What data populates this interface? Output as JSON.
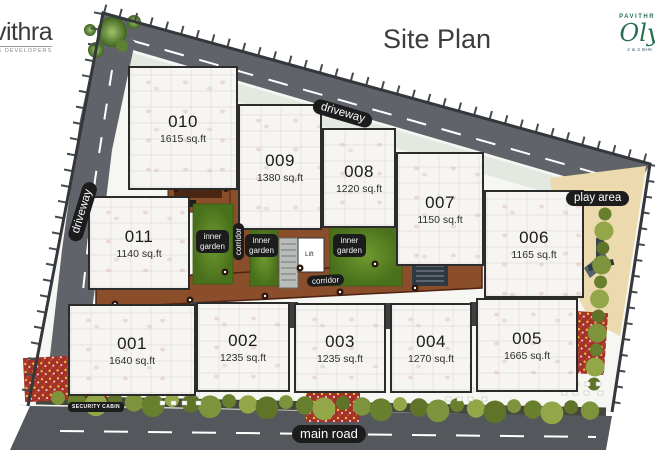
{
  "title": "Site Plan",
  "logo_left": {
    "name": "vithra",
    "tagline": "& DEVELOPERS"
  },
  "logo_right": {
    "brand": "PAVITHRA",
    "name": "Oly",
    "tagline": "2 & 3 BHK"
  },
  "units": [
    {
      "id": "010",
      "area": "1615 sq.ft"
    },
    {
      "id": "009",
      "area": "1380 sq.ft"
    },
    {
      "id": "008",
      "area": "1220 sq.ft"
    },
    {
      "id": "007",
      "area": "1150 sq.ft"
    },
    {
      "id": "006",
      "area": "1165 sq.ft"
    },
    {
      "id": "011",
      "area": "1140 sq.ft"
    },
    {
      "id": "001",
      "area": "1640 sq.ft"
    },
    {
      "id": "002",
      "area": "1235 sq.ft"
    },
    {
      "id": "003",
      "area": "1235 sq.ft"
    },
    {
      "id": "004",
      "area": "1270 sq.ft"
    },
    {
      "id": "005",
      "area": "1665 sq.ft"
    }
  ],
  "labels": {
    "driveway_top": "driveway",
    "driveway_left": "driveway",
    "corridor_horizontal": "corridor",
    "corridor_vertical": "corridor",
    "inner_garden_line1": "inner",
    "inner_garden_line2": "garden",
    "play_area": "play area",
    "main_road": "main road",
    "security_cabin": "SECURITY CABIN",
    "lift": "Lift"
  },
  "colors": {
    "corridor_brown": "#8b4e2b",
    "garden_green": "#4f7a1d",
    "road_gray": "#5a5e62",
    "play_area_beige": "#ecd9ad",
    "label_bg": "#1c1c1c",
    "flower_red": "#a5322a",
    "hedge_green": "#7d943c",
    "brand_green": "#2a6e4f"
  }
}
